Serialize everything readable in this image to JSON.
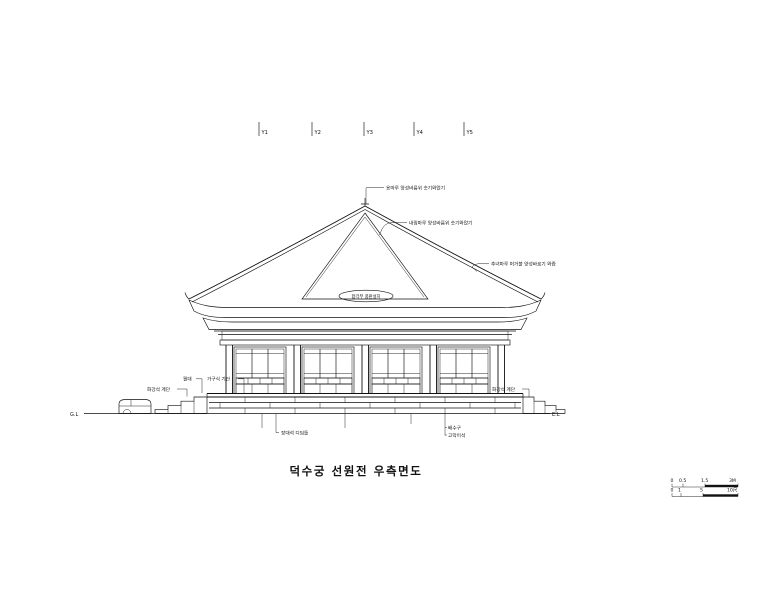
{
  "drawing": {
    "title": "덕수궁 선원전 우측면도",
    "grid_labels": [
      "Y1",
      "Y2",
      "Y3",
      "Y4",
      "Y5"
    ],
    "annotations": {
      "ridge": "용마루 양성바름위 숫기와얹기",
      "descending_ridge": "내림마루 양성바름위 숫기와얹기",
      "hip_ridge": "추녀마루 머거불 양성바르기 와즙",
      "gable": "합각부 풍판설치",
      "left_stair": "화강석 계단",
      "right_stair": "화강석 계단",
      "woldae": "월대",
      "stylobate": "가구식 기단",
      "stepping_stone": "장대석 디딤돌",
      "drain": "배수구",
      "gomaki_stone": "고막이석",
      "ground_left": "G.L",
      "ground_right": "E.L"
    },
    "scale_bar": {
      "meter_labels": [
        "0",
        "0.5",
        "1.5",
        "3M"
      ],
      "cheok_labels": [
        "0",
        "1",
        "5",
        "10尺"
      ]
    },
    "colors": {
      "ink": "#111111",
      "paper": "#ffffff"
    }
  }
}
